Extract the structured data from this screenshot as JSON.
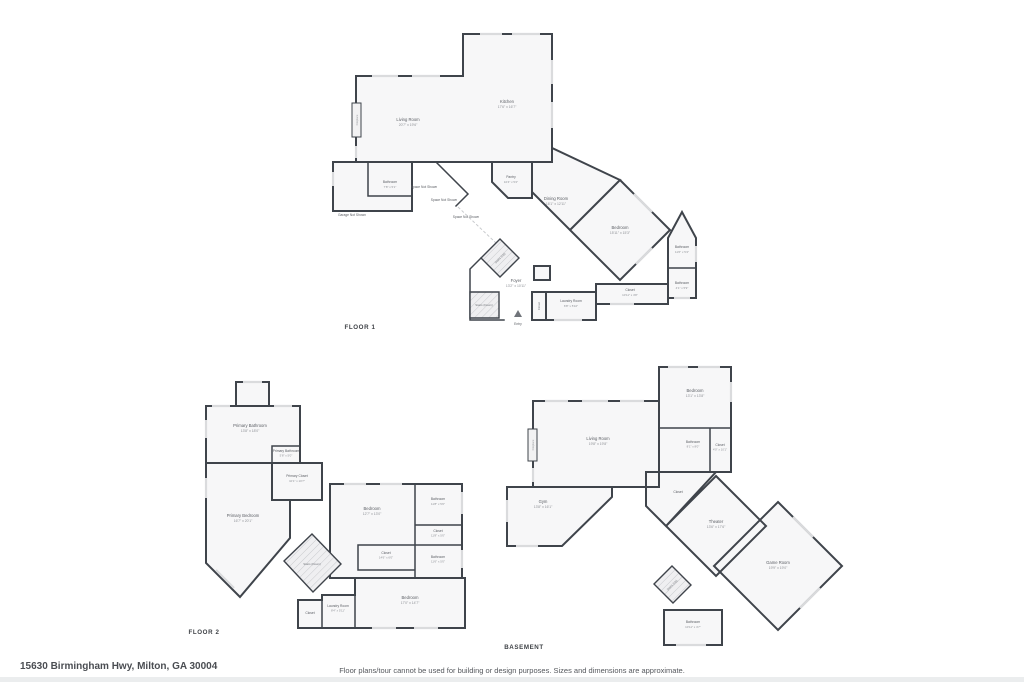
{
  "page": {
    "background": "#ffffff",
    "address": "15630 Birmingham Hwy, Milton, GA 30004",
    "disclaimer": "Floor plans/tour cannot be used for building or design purposes. Sizes and dimensions are approximate.",
    "colors": {
      "wall": "#3f444b",
      "room_fill": "#f7f7f8",
      "window": "#dadbdd",
      "stair_hatch": "#c9cbce"
    }
  },
  "floors": [
    {
      "label": "FLOOR 1",
      "rooms": [
        {
          "name": "Living Room",
          "dims": "20'7\" x 19'6\""
        },
        {
          "name": "Kitchen",
          "dims": "17'6\" x 16'7\""
        },
        {
          "name": "Bathroom",
          "dims": "7'8\" x 5'1\""
        },
        {
          "name": "Garage Not Shown",
          "dims": ""
        },
        {
          "name": "Space Not Shown",
          "dims": ""
        },
        {
          "name": "Space Not Shown",
          "dims": ""
        },
        {
          "name": "Space Not Shown",
          "dims": ""
        },
        {
          "name": "Pantry",
          "dims": "10'4\" x 5'2\""
        },
        {
          "name": "Dining Room",
          "dims": "16'1\" x 12'11\""
        },
        {
          "name": "Bedroom",
          "dims": "15'11\" x 15'3\""
        },
        {
          "name": "Bathroom",
          "dims": "11'6\" x 5'4\""
        },
        {
          "name": "Bathroom",
          "dims": "4'1\" x 5'9\""
        },
        {
          "name": "Closet",
          "dims": "10'11\" x 4'8\""
        },
        {
          "name": "Stairs (Up)",
          "dims": ""
        },
        {
          "name": "Stairs (Down)",
          "dims": ""
        },
        {
          "name": "Foyer",
          "dims": "13'2\" x 10'11\""
        },
        {
          "name": "Laundry Room",
          "dims": "6'8\" x 5'10\""
        },
        {
          "name": "Closet",
          "dims": ""
        },
        {
          "name": "Entry",
          "dims": ""
        },
        {
          "name": "Fireplace",
          "dims": ""
        }
      ]
    },
    {
      "label": "FLOOR 2",
      "rooms": [
        {
          "name": "Primary Bathroom",
          "dims": "13'8\" x 18'0\""
        },
        {
          "name": "Primary Bathroom",
          "dims": "5'8\" x 5'0\""
        },
        {
          "name": "Primary Closet",
          "dims": "10'1\" x 10'7\""
        },
        {
          "name": "Primary Bedroom",
          "dims": "16'7\" x 20'1\""
        },
        {
          "name": "Bedroom",
          "dims": "12'7\" x 13'0\""
        },
        {
          "name": "Bathroom",
          "dims": "11'8\" x 5'0\""
        },
        {
          "name": "Closet",
          "dims": "11'8\" x 5'0\""
        },
        {
          "name": "Closet",
          "dims": "14'6\" x 6'0\""
        },
        {
          "name": "Bathroom",
          "dims": "11'6\" x 5'0\""
        },
        {
          "name": "Stairs (Down)",
          "dims": ""
        },
        {
          "name": "Closet",
          "dims": ""
        },
        {
          "name": "Laundry Room",
          "dims": "8'4\" x 5'11\""
        },
        {
          "name": "Bedroom",
          "dims": "17'0\" x 14'7\""
        }
      ]
    },
    {
      "label": "BASEMENT",
      "rooms": [
        {
          "name": "Bedroom",
          "dims": "13'1\" x 13'8\""
        },
        {
          "name": "Bathroom",
          "dims": "8'1\" x 8'0\""
        },
        {
          "name": "Closet",
          "dims": "4'0\" x 10'1\""
        },
        {
          "name": "Living Room",
          "dims": "19'8\" x 19'8\""
        },
        {
          "name": "Fireplace",
          "dims": ""
        },
        {
          "name": "Gym",
          "dims": "13'8\" x 16'1\""
        },
        {
          "name": "Closet",
          "dims": ""
        },
        {
          "name": "Theater",
          "dims": "13'6\" x 17'6\""
        },
        {
          "name": "Stairs (Up)",
          "dims": ""
        },
        {
          "name": "Game Room",
          "dims": "19'9\" x 19'0\""
        },
        {
          "name": "Bathroom",
          "dims": "10'11\" x 4'7\""
        }
      ]
    }
  ]
}
